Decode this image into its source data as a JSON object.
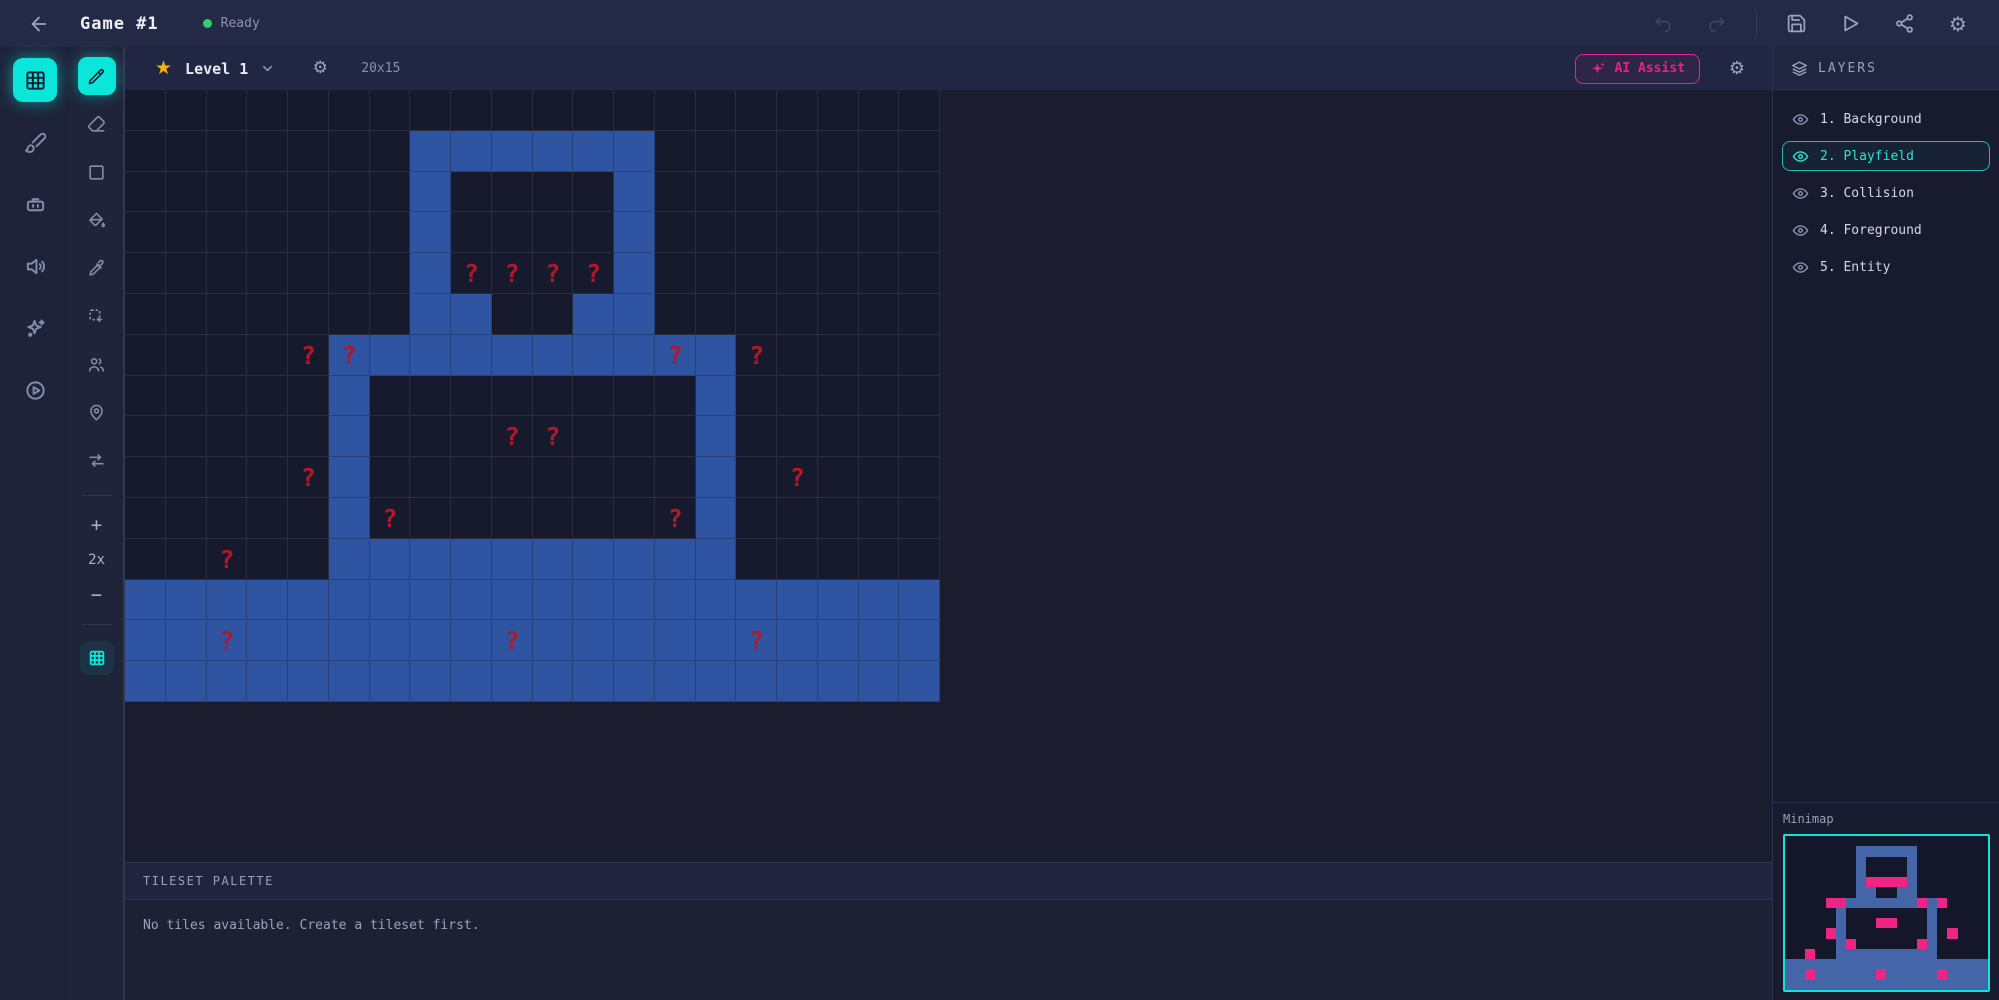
{
  "colors": {
    "accent": "#0ae6da",
    "magenta": "#e82190",
    "tile_blue": "#2f55a2",
    "question_red": "#b2182b",
    "minimap_blue": "#4465a8",
    "minimap_pink": "#ee2584",
    "star_gold": "#f3b117",
    "status_green": "#2fd069",
    "selected_layer": "#2ee0cf"
  },
  "topbar": {
    "title": "Game #1",
    "status": "Ready"
  },
  "rail": {
    "items": [
      "tilemap-editor",
      "paint-editor",
      "bot-assistant",
      "audio-editor",
      "effects-editor",
      "preview-player"
    ]
  },
  "tools": {
    "items": [
      "pencil",
      "eraser",
      "rectangle",
      "fill-bucket",
      "eyedropper",
      "marquee-select",
      "collaborators",
      "map-pin",
      "swap-layers",
      "grid-toggle"
    ]
  },
  "zoom": {
    "in": "+",
    "level": "2x",
    "out": "−"
  },
  "canvas_toolbar": {
    "level_name": "Level 1",
    "grid_size": "20x15",
    "ai_assist_label": "AI Assist"
  },
  "layers": {
    "header": "LAYERS",
    "items": [
      {
        "label": "1. Background",
        "selected": false
      },
      {
        "label": "2. Playfield",
        "selected": true
      },
      {
        "label": "3. Collision",
        "selected": false
      },
      {
        "label": "4. Foreground",
        "selected": false
      },
      {
        "label": "5. Entity",
        "selected": false
      }
    ]
  },
  "minimap": {
    "label": "Minimap"
  },
  "palette": {
    "header": "TILESET PALETTE",
    "empty_message": "No tiles available. Create a tileset first."
  },
  "canvas": {
    "cols": 20,
    "rows": 15,
    "question_char": "?",
    "legend": {
      ".": "empty",
      "B": "blue-tile",
      "?": "question-on-empty",
      "Q": "question-on-blue-tile"
    },
    "tilemap": [
      "....................",
      ".......BBBBBB.......",
      ".......B....B.......",
      ".......B....B.......",
      ".......B????B.......",
      ".......BB..BB.......",
      "....?QBBBBBBBQB?....",
      ".....B........B.....",
      ".....B...??...B.....",
      "....?B........B.?...",
      ".....B?......?B.....",
      "..?..BBBBBBBBBB.....",
      "BBBBBBBBBBBBBBBBBBBB",
      "BBQBBBBBBQBBBBBQBBBB",
      "BBBBBBBBBBBBBBBBBBBB"
    ]
  }
}
